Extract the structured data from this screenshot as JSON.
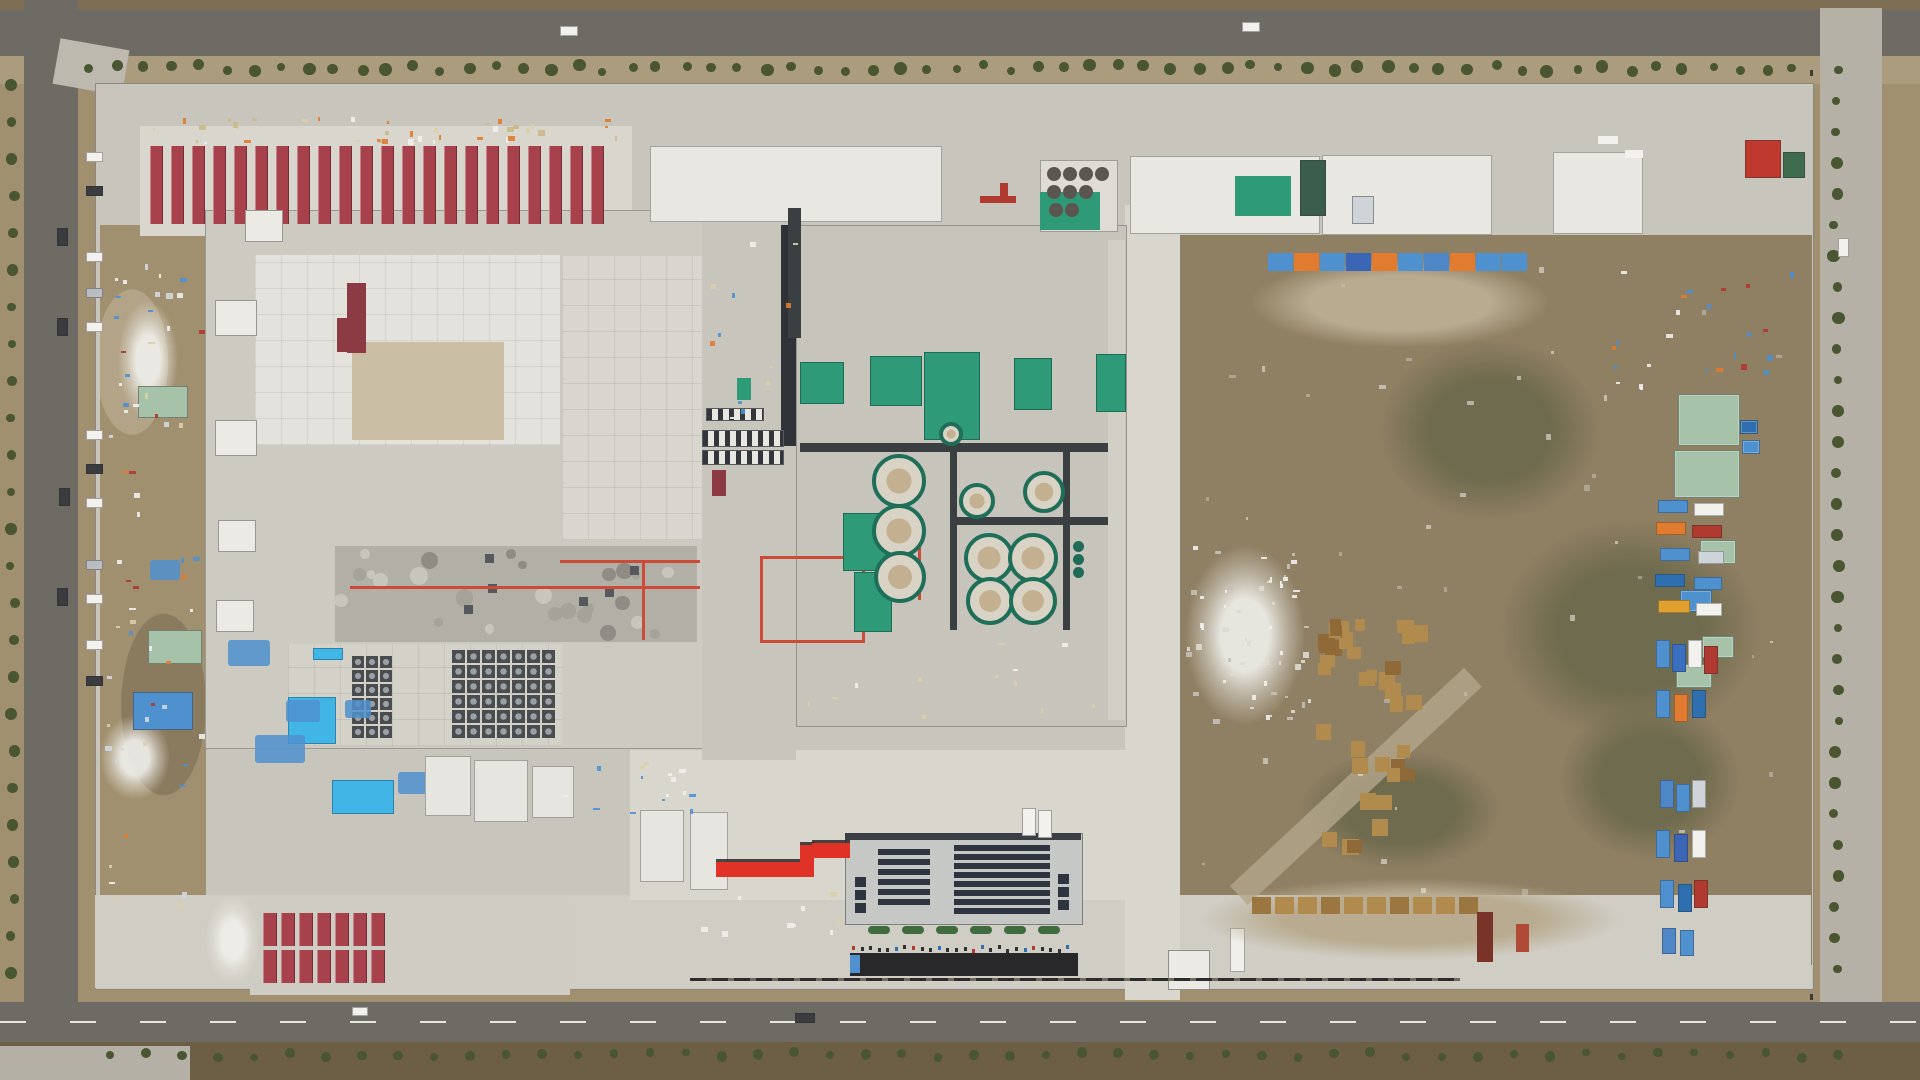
{
  "meta": {
    "type": "aerial-photograph",
    "subject": "Top-down drone view of a large industrial plant construction site: red-roofed worker camp rows, white process buildings, water-treatment clarifier tanks on green pads, a solar-roofed administration building, dirt laydown yards with stored materials, and perimeter asphalt roads lined with young trees"
  },
  "palette": {
    "terrain": "#a1906f",
    "terrain_dark": "#857253",
    "field": "#7d6e54",
    "field_dark": "#6d5f45",
    "road": "#6e6b64",
    "shoulder": "#ab9c7e",
    "concrete": "#c8c5bc",
    "concrete_bright": "#d9d6ce",
    "roof_white": "#e8e7e2",
    "yard": "#8f7f63",
    "red_roof": "#a7414b",
    "red_roof_dark": "#8c3a44",
    "red_bright": "#e03226",
    "green_equip": "#2f9a78",
    "green_dark": "#206b57",
    "sage_roof": "#a6c2a9",
    "pool_blue": "#41b5e6",
    "tarp_blue": "#4f90cf",
    "orange": "#e07b30",
    "solar_panel": "#2e3440",
    "black_strip": "#28282b",
    "pallet_wood": "#b18a4e",
    "tree_green": "#4a5631",
    "tank_ring": "#1f6e5a",
    "tank_fill": "#d8d3c4",
    "tank_center": "#c2b091",
    "pipe_red": "#cc4a38",
    "mech_gray": "#b2afa7",
    "white": "#f2f1ee",
    "dark_car": "#3a3c40",
    "silver": "#b9bcc0"
  },
  "areas": {
    "worker_camp_north": "22 rows of red-roofed worker dormitories",
    "worker_camp_south": "two rows of red-roofed dormitory blocks",
    "main_plant": "large white plant building with rooftop piping and fan arrays",
    "process_building": "central utility building with green pads and circular clarifier tanks",
    "solar_building": "administration building with rooftop solar panels",
    "east_yard": "dirt laydown yard with pallet stacks, sheds and parked trucks",
    "red_walkway": "bright red elevated walkway between buildings"
  },
  "features": {
    "barracks_top": {
      "x": 150,
      "y": 146,
      "h": 78,
      "count": 22,
      "stripe_w": 13,
      "gap": 8
    },
    "barracks_bottom": {
      "x": 263,
      "y": 913,
      "cols": 7,
      "rows": 2,
      "stripe_w": 14,
      "gap": 4,
      "h": 33,
      "row_gap": 4
    },
    "treelines": {
      "top": {
        "y": 64,
        "x0": 88,
        "x1": 1795,
        "step": 27
      },
      "left": {
        "x": 10,
        "y0": 85,
        "y1": 995,
        "step": 37
      },
      "right": {
        "x": 1833,
        "y0": 70,
        "y1": 1000,
        "step": 31
      },
      "bottom": {
        "y": 1052,
        "x0": 110,
        "x1": 1840,
        "step": 36
      }
    },
    "cars_west": {
      "x": 86,
      "w": 15,
      "h": 8,
      "ys": [
        152,
        186,
        252,
        288,
        322,
        430,
        464,
        498,
        560,
        594,
        640,
        676
      ],
      "colors": [
        "white",
        "dark_car",
        "white",
        "silver",
        "white",
        "white",
        "dark_car",
        "white",
        "silver",
        "white",
        "white",
        "dark_car"
      ]
    },
    "road_cars": [
      {
        "x": 57,
        "y": 228,
        "w": 9,
        "h": 16,
        "c": "dark_car"
      },
      {
        "x": 57,
        "y": 318,
        "w": 9,
        "h": 16,
        "c": "dark_car"
      },
      {
        "x": 59,
        "y": 488,
        "w": 9,
        "h": 16,
        "c": "dark_car"
      },
      {
        "x": 57,
        "y": 588,
        "w": 9,
        "h": 16,
        "c": "dark_car"
      },
      {
        "x": 560,
        "y": 26,
        "w": 16,
        "h": 8,
        "c": "white"
      },
      {
        "x": 1242,
        "y": 22,
        "w": 16,
        "h": 8,
        "c": "white"
      },
      {
        "x": 795,
        "y": 1013,
        "w": 18,
        "h": 8,
        "c": "dark_car"
      },
      {
        "x": 352,
        "y": 1007,
        "w": 14,
        "h": 7,
        "c": "white"
      },
      {
        "x": 1838,
        "y": 238,
        "w": 9,
        "h": 17,
        "c": "white"
      },
      {
        "x": 1022,
        "y": 808,
        "w": 12,
        "h": 26,
        "c": "white"
      },
      {
        "x": 1038,
        "y": 810,
        "w": 12,
        "h": 26,
        "c": "white"
      }
    ],
    "west_cubes": [
      {
        "x": 215,
        "y": 300,
        "w": 40,
        "h": 34
      },
      {
        "x": 215,
        "y": 420,
        "w": 40,
        "h": 34
      },
      {
        "x": 218,
        "y": 520,
        "w": 36,
        "h": 30
      },
      {
        "x": 216,
        "y": 600,
        "w": 36,
        "h": 30
      },
      {
        "x": 245,
        "y": 210,
        "w": 36,
        "h": 30
      }
    ],
    "red_roof_strip": [
      {
        "x": 347,
        "y": 283,
        "w": 19,
        "h": 70
      },
      {
        "x": 337,
        "y": 318,
        "w": 12,
        "h": 34
      }
    ],
    "mech_band": {
      "x": 340,
      "y": 552,
      "w": 350,
      "h": 84,
      "units": 26,
      "squares": 6
    },
    "fan_grid_a": {
      "x": 452,
      "y": 650,
      "cols": 7,
      "rows": 6,
      "cell": 15
    },
    "fan_grid_b": {
      "x": 352,
      "y": 656,
      "cols": 3,
      "rows": 6,
      "cell": 14
    },
    "red_pipes": [
      {
        "x": 350,
        "y": 586,
        "w": 350,
        "h": 3
      },
      {
        "x": 560,
        "y": 560,
        "w": 140,
        "h": 3
      },
      {
        "x": 642,
        "y": 560,
        "w": 3,
        "h": 80
      },
      {
        "x": 760,
        "y": 556,
        "w": 105,
        "h": 3
      },
      {
        "x": 760,
        "y": 640,
        "w": 105,
        "h": 3
      },
      {
        "x": 760,
        "y": 556,
        "w": 3,
        "h": 87
      },
      {
        "x": 862,
        "y": 556,
        "w": 3,
        "h": 87
      },
      {
        "x": 918,
        "y": 540,
        "w": 3,
        "h": 60
      }
    ],
    "pools_blue": [
      {
        "x": 288,
        "y": 697,
        "w": 46,
        "h": 45
      },
      {
        "x": 332,
        "y": 780,
        "w": 60,
        "h": 32
      },
      {
        "x": 313,
        "y": 648,
        "w": 28,
        "h": 10
      }
    ],
    "tarp_piles_west": [
      {
        "x": 228,
        "y": 640,
        "w": 42,
        "h": 26
      },
      {
        "x": 286,
        "y": 700,
        "w": 34,
        "h": 22
      },
      {
        "x": 255,
        "y": 735,
        "w": 50,
        "h": 28
      },
      {
        "x": 345,
        "y": 700,
        "w": 26,
        "h": 18
      },
      {
        "x": 398,
        "y": 772,
        "w": 38,
        "h": 22
      },
      {
        "x": 150,
        "y": 560,
        "w": 30,
        "h": 20
      }
    ],
    "annex_blocks": [
      {
        "x": 425,
        "y": 756,
        "w": 44,
        "h": 58
      },
      {
        "x": 474,
        "y": 760,
        "w": 52,
        "h": 60
      },
      {
        "x": 532,
        "y": 766,
        "w": 40,
        "h": 50
      },
      {
        "x": 640,
        "y": 810,
        "w": 42,
        "h": 70
      },
      {
        "x": 690,
        "y": 812,
        "w": 36,
        "h": 76
      }
    ],
    "bridges": [
      {
        "x": 702,
        "y": 430,
        "w": 80,
        "h": 15
      },
      {
        "x": 702,
        "y": 450,
        "w": 80,
        "h": 13
      },
      {
        "x": 706,
        "y": 408,
        "w": 56,
        "h": 11
      }
    ],
    "green_pads": [
      {
        "x": 800,
        "y": 362,
        "w": 42,
        "h": 40
      },
      {
        "x": 870,
        "y": 356,
        "w": 50,
        "h": 48
      },
      {
        "x": 924,
        "y": 352,
        "w": 54,
        "h": 86
      },
      {
        "x": 1014,
        "y": 358,
        "w": 36,
        "h": 50
      },
      {
        "x": 1096,
        "y": 354,
        "w": 28,
        "h": 56
      },
      {
        "x": 843,
        "y": 513,
        "w": 42,
        "h": 56
      },
      {
        "x": 854,
        "y": 572,
        "w": 36,
        "h": 58
      }
    ],
    "dark_bands": [
      {
        "x": 800,
        "y": 443,
        "w": 308,
        "h": 9
      },
      {
        "x": 950,
        "y": 517,
        "w": 158,
        "h": 8
      },
      {
        "x": 950,
        "y": 443,
        "w": 7,
        "h": 187
      },
      {
        "x": 1063,
        "y": 443,
        "w": 7,
        "h": 187
      },
      {
        "x": 788,
        "y": 208,
        "w": 13,
        "h": 130
      }
    ],
    "clarifiers": [
      {
        "cx": 895,
        "cy": 477,
        "d": 46
      },
      {
        "cx": 895,
        "cy": 527,
        "d": 46
      },
      {
        "cx": 896,
        "cy": 573,
        "d": 44
      },
      {
        "cx": 973,
        "cy": 497,
        "d": 28
      },
      {
        "cx": 1040,
        "cy": 488,
        "d": 34
      },
      {
        "cx": 985,
        "cy": 554,
        "d": 42
      },
      {
        "cx": 1029,
        "cy": 554,
        "d": 42
      },
      {
        "cx": 986,
        "cy": 597,
        "d": 40
      },
      {
        "cx": 1029,
        "cy": 597,
        "d": 40
      },
      {
        "cx": 947,
        "cy": 430,
        "d": 16
      }
    ],
    "silos": [
      {
        "cx": 1078,
        "cy": 546,
        "d": 11
      },
      {
        "cx": 1078,
        "cy": 559,
        "d": 11
      },
      {
        "cx": 1078,
        "cy": 572,
        "d": 11
      }
    ],
    "equip_circles": {
      "d": 14,
      "pts": [
        [
          1054,
          174
        ],
        [
          1070,
          174
        ],
        [
          1086,
          174
        ],
        [
          1102,
          174
        ],
        [
          1054,
          192
        ],
        [
          1070,
          192
        ],
        [
          1086,
          192
        ],
        [
          1056,
          210
        ],
        [
          1072,
          210
        ]
      ]
    },
    "tarp_row": {
      "x": 1268,
      "y": 253,
      "h": 18,
      "seg_w": 25,
      "gap": 1,
      "segments": [
        "tarp_blue",
        "orange",
        "tarp_blue",
        "#3a66b5",
        "orange",
        "tarp_blue",
        "#4f86c8",
        "orange",
        "tarp_blue",
        "tarp_blue"
      ]
    },
    "pallet_cluster": {
      "x": 1312,
      "y": 618,
      "w": 118,
      "h": 240,
      "count": 36
    },
    "pallet_row": {
      "x": 1252,
      "y": 897,
      "count": 10,
      "w": 19,
      "h": 17,
      "gap": 4
    },
    "containers_bottom": [
      {
        "x": 1477,
        "y": 912,
        "w": 16,
        "h": 50,
        "c": "#7a3328"
      },
      {
        "x": 1516,
        "y": 924,
        "w": 13,
        "h": 28,
        "c": "#b04a36"
      }
    ],
    "sheds_east": [
      {
        "x": 1678,
        "y": 394,
        "w": 60,
        "h": 50,
        "c": "sage_roof"
      },
      {
        "x": 1674,
        "y": 450,
        "w": 64,
        "h": 46,
        "c": "sage_roof"
      },
      {
        "x": 1700,
        "y": 540,
        "w": 34,
        "h": 22,
        "c": "sage_roof"
      },
      {
        "x": 1680,
        "y": 590,
        "w": 30,
        "h": 20,
        "c": "tarp_blue"
      },
      {
        "x": 1702,
        "y": 636,
        "w": 30,
        "h": 20,
        "c": "sage_roof"
      },
      {
        "x": 1676,
        "y": 664,
        "w": 34,
        "h": 22,
        "c": "sage_roof"
      },
      {
        "x": 1740,
        "y": 420,
        "w": 16,
        "h": 12,
        "c": "#2e6fb0"
      },
      {
        "x": 1742,
        "y": 440,
        "w": 16,
        "h": 12,
        "c": "tarp_blue"
      }
    ],
    "vehicles_right": [
      {
        "x": 1658,
        "y": 500,
        "w": 28,
        "h": 11,
        "c": "tarp_blue"
      },
      {
        "x": 1694,
        "y": 503,
        "w": 28,
        "h": 11,
        "c": "white"
      },
      {
        "x": 1656,
        "y": 522,
        "w": 28,
        "h": 11,
        "c": "orange"
      },
      {
        "x": 1692,
        "y": 525,
        "w": 28,
        "h": 11,
        "c": "#b03a30"
      },
      {
        "x": 1660,
        "y": 548,
        "w": 28,
        "h": 11,
        "c": "tarp_blue"
      },
      {
        "x": 1698,
        "y": 551,
        "w": 24,
        "h": 11,
        "c": "#cfd4d8"
      },
      {
        "x": 1655,
        "y": 574,
        "w": 28,
        "h": 11,
        "c": "#2e6fb0"
      },
      {
        "x": 1694,
        "y": 577,
        "w": 26,
        "h": 11,
        "c": "tarp_blue"
      },
      {
        "x": 1658,
        "y": 600,
        "w": 30,
        "h": 11,
        "c": "#e0a030"
      },
      {
        "x": 1696,
        "y": 603,
        "w": 24,
        "h": 11,
        "c": "white"
      },
      {
        "x": 1656,
        "y": 640,
        "w": 12,
        "h": 26,
        "c": "tarp_blue"
      },
      {
        "x": 1672,
        "y": 644,
        "w": 12,
        "h": 26,
        "c": "#3a6fc0"
      },
      {
        "x": 1688,
        "y": 640,
        "w": 12,
        "h": 26,
        "c": "white"
      },
      {
        "x": 1704,
        "y": 646,
        "w": 12,
        "h": 26,
        "c": "#b03a30"
      },
      {
        "x": 1656,
        "y": 690,
        "w": 12,
        "h": 26,
        "c": "tarp_blue"
      },
      {
        "x": 1674,
        "y": 694,
        "w": 12,
        "h": 26,
        "c": "orange"
      },
      {
        "x": 1692,
        "y": 690,
        "w": 12,
        "h": 26,
        "c": "#2e6fb0"
      },
      {
        "x": 1660,
        "y": 780,
        "w": 12,
        "h": 26,
        "c": "#4f86c8"
      },
      {
        "x": 1676,
        "y": 784,
        "w": 12,
        "h": 26,
        "c": "tarp_blue"
      },
      {
        "x": 1692,
        "y": 780,
        "w": 12,
        "h": 26,
        "c": "#cfd4d8"
      },
      {
        "x": 1656,
        "y": 830,
        "w": 12,
        "h": 26,
        "c": "tarp_blue"
      },
      {
        "x": 1674,
        "y": 834,
        "w": 12,
        "h": 26,
        "c": "#3a66b5"
      },
      {
        "x": 1692,
        "y": 830,
        "w": 12,
        "h": 26,
        "c": "white"
      },
      {
        "x": 1660,
        "y": 880,
        "w": 12,
        "h": 26,
        "c": "tarp_blue"
      },
      {
        "x": 1678,
        "y": 884,
        "w": 12,
        "h": 26,
        "c": "#2e6fb0"
      },
      {
        "x": 1694,
        "y": 880,
        "w": 12,
        "h": 26,
        "c": "#b03a30"
      },
      {
        "x": 1662,
        "y": 928,
        "w": 12,
        "h": 24,
        "c": "#4f86c8"
      },
      {
        "x": 1680,
        "y": 930,
        "w": 12,
        "h": 24,
        "c": "tarp_blue"
      }
    ],
    "solar": {
      "left_block": {
        "x": 878,
        "y": 849,
        "w": 52,
        "rows": 6,
        "row_h": 6,
        "gap": 4
      },
      "right_block": {
        "x": 954,
        "y": 845,
        "w": 96,
        "rows": 8,
        "row_h": 6,
        "gap": 3
      },
      "side_left": {
        "x": 855,
        "y": 877,
        "count": 3,
        "step": 13,
        "w": 11,
        "h": 10
      },
      "side_right": {
        "x": 1058,
        "y": 874,
        "count": 3,
        "step": 13,
        "w": 11,
        "h": 10
      },
      "bushes": {
        "y": 926,
        "x0": 868,
        "count": 6,
        "step": 34,
        "w": 22,
        "h": 8
      }
    },
    "red_corridor": [
      {
        "x": 716,
        "y": 862,
        "w": 88,
        "h": 15
      },
      {
        "x": 800,
        "y": 845,
        "w": 14,
        "h": 32
      },
      {
        "x": 812,
        "y": 843,
        "w": 38,
        "h": 15
      }
    ],
    "black_strip": {
      "x": 850,
      "y": 953,
      "w": 228,
      "h": 23
    },
    "people_row": {
      "y": 947,
      "x0": 852,
      "x1": 1075,
      "count": 26
    },
    "huts": [
      {
        "x": 138,
        "y": 386,
        "w": 48,
        "h": 30,
        "c": "sage_roof"
      },
      {
        "x": 148,
        "y": 630,
        "w": 52,
        "h": 32,
        "c": "sage_roof"
      },
      {
        "x": 133,
        "y": 692,
        "w": 58,
        "h": 36,
        "c": "tarp_blue"
      },
      {
        "x": 1745,
        "y": 140,
        "w": 34,
        "h": 36,
        "c": "#c0392f"
      },
      {
        "x": 1783,
        "y": 152,
        "w": 20,
        "h": 24,
        "c": "#3f6b4f"
      },
      {
        "x": 1300,
        "y": 160,
        "w": 24,
        "h": 54,
        "c": "#3b5d4e"
      },
      {
        "x": 1352,
        "y": 196,
        "w": 20,
        "h": 26,
        "c": "#cfd4d8"
      }
    ],
    "white_debris_blobs": [
      {
        "x": 205,
        "y": 895,
        "w": 55,
        "h": 90
      },
      {
        "x": 100,
        "y": 715,
        "w": 70,
        "h": 85
      },
      {
        "x": 1185,
        "y": 545,
        "w": 120,
        "h": 180
      },
      {
        "x": 118,
        "y": 300,
        "w": 60,
        "h": 120
      }
    ],
    "crane_parts": [
      {
        "x": 980,
        "y": 196,
        "w": 36,
        "h": 7,
        "c": "#b03a30"
      },
      {
        "x": 1000,
        "y": 183,
        "w": 8,
        "h": 18,
        "c": "#b03a30"
      },
      {
        "x": 1598,
        "y": 136,
        "w": 20,
        "h": 8,
        "c": "white"
      },
      {
        "x": 1625,
        "y": 150,
        "w": 18,
        "h": 8,
        "c": "white"
      }
    ]
  }
}
